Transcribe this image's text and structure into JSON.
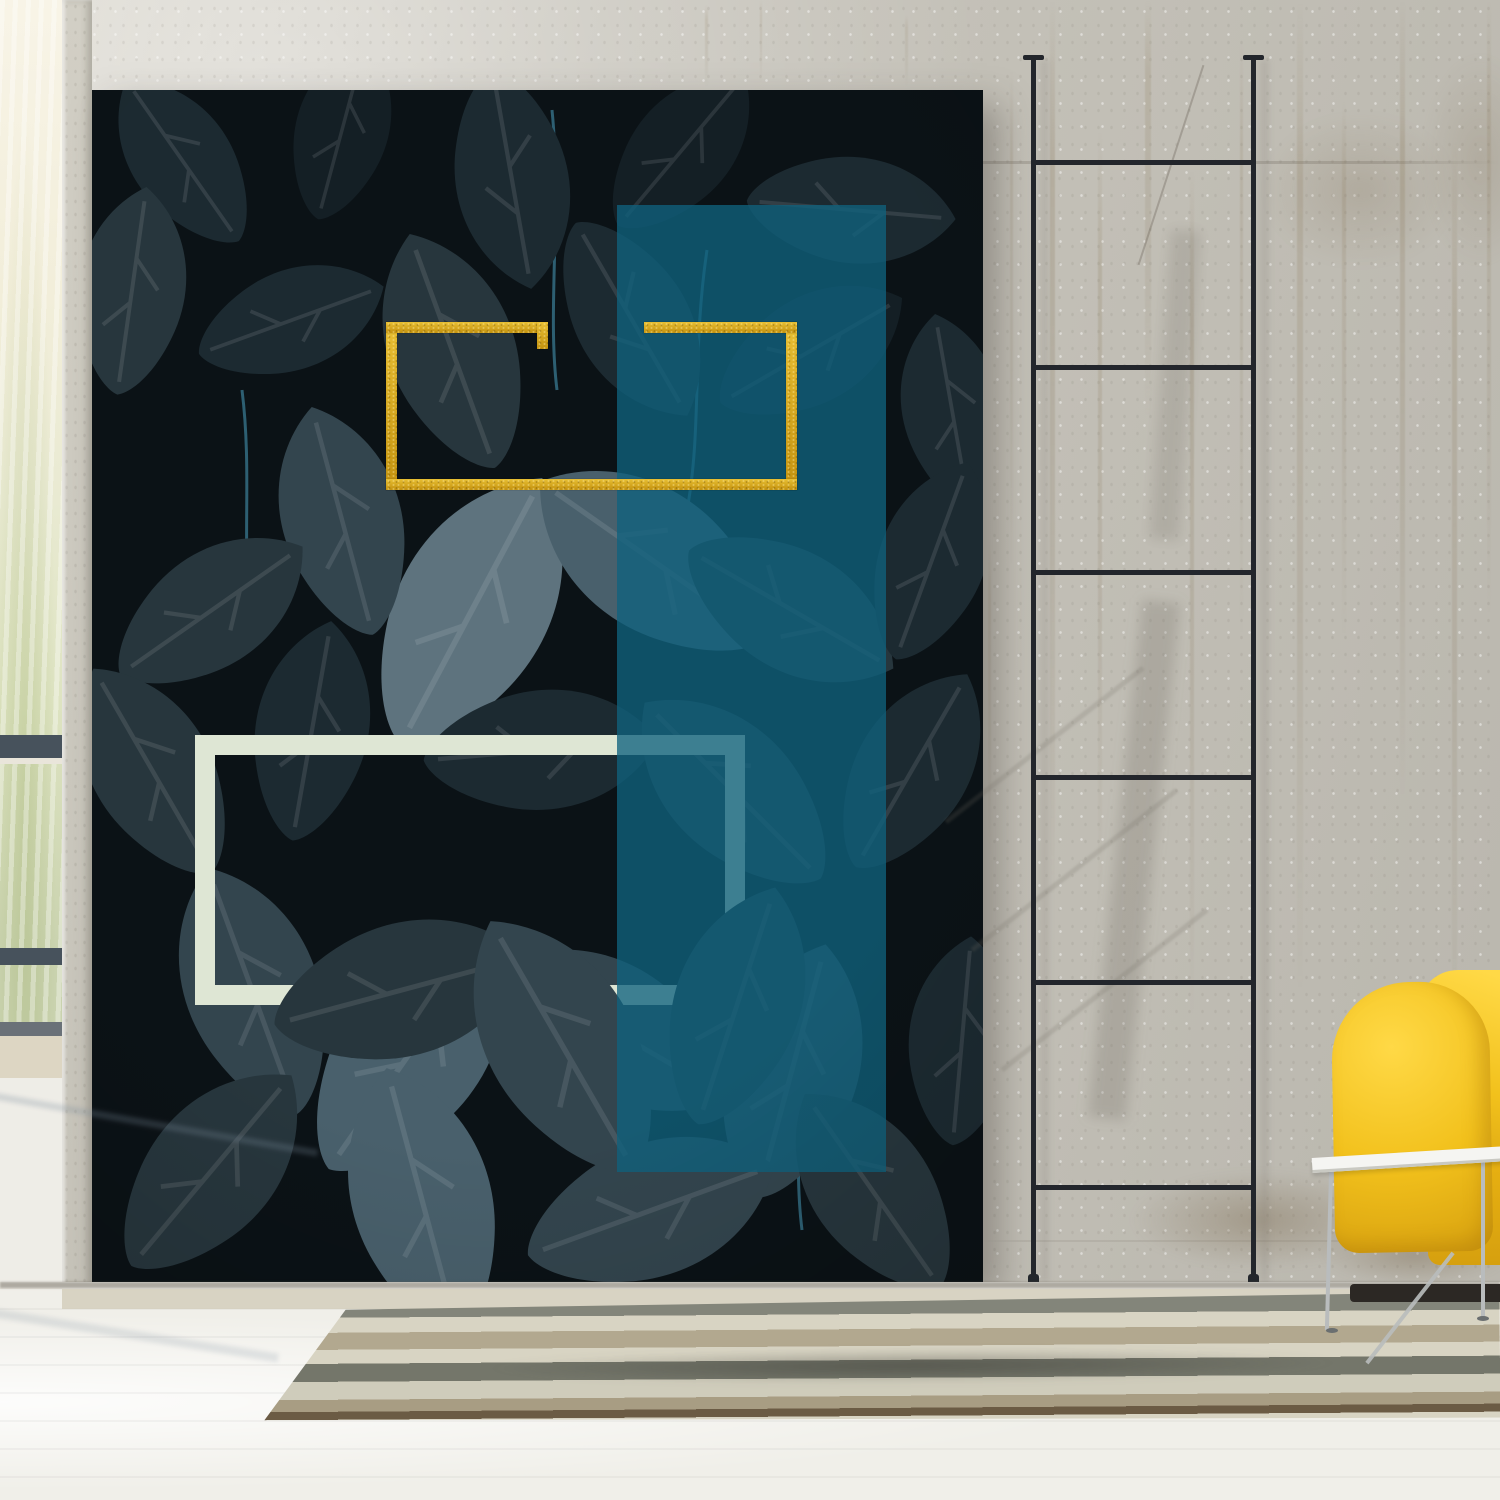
{
  "scene": {
    "description": "Bright loft interior: a tall botanical poster of dark blue-green leaves leans against a stained concrete wall; the artwork carries a gold glitter rectangle outline, a translucent teal vertical color block and a pale mint rectangle outline. A thin black ladder leans on the wall to the right, a yellow armchair with a white wire-leg coffee table sits in the lower right corner, a striped flat-weave rug lies on the whitewashed floor, and daylight enters from a window strip at the far left.",
    "wall_art": {
      "label": "leaf-poster",
      "elements": [
        "dark-leaf-photograph",
        "gold-glitter-frame",
        "teal-color-block",
        "mint-frame"
      ],
      "gold_frame_has_gap_in_top_edge": true,
      "leaf_overlap_on_mint_bottom_edge": true
    },
    "ladder": {
      "rungs": 6,
      "rails": 2
    },
    "rug": {
      "stripe_count": 8
    },
    "furniture": {
      "armchair": "yellow-fabric",
      "table": "white-top-wire-legs"
    },
    "window": {
      "mullion_bars": 2,
      "view": "out-of-focus-greenery"
    }
  },
  "colors": {
    "wall": "#c7c4bb",
    "wall-light": "#dcd9d0",
    "streak": "#8b7755",
    "stain": "#7d6c52",
    "window-top": "#f8f4e7",
    "window-grass": "#dde3c1",
    "window-grass-dark": "#c9d2ae",
    "window-frame": "#47525c",
    "sill": "#ddd6c3",
    "column": "#d2cfc5",
    "poster-bg": "#0b1216",
    "leaf-1": "#141f25",
    "leaf-2": "#1c2a31",
    "leaf-3": "#27363d",
    "leaf-4": "#33454e",
    "leaf-5": "#49606c",
    "leaf-6": "#5e737e",
    "stem": "#4089a4",
    "teal": "#10617e",
    "gold-1": "#e8bf33",
    "gold-2": "#c3920f",
    "mint": "#dee6d4",
    "ladder": "#23262c",
    "chair-1": "#ffd946",
    "chair-2": "#f2c11c",
    "chair-3": "#d6a00f",
    "chair-base": "#2c2824",
    "table-top": "#f5f5f2",
    "table-edge": "#c9c9c2",
    "table-leg": "#b9bcbd",
    "rug-1": "#83857a",
    "rug-2": "#d8d4c3",
    "rug-3": "#b2a88f",
    "rug-5": "#74766a",
    "rug-6": "#cfccbb",
    "rug-7": "#a89d83",
    "rug-8": "#6b5b44",
    "floor": "#f0efe9",
    "baseboard": "#d0cab6"
  }
}
